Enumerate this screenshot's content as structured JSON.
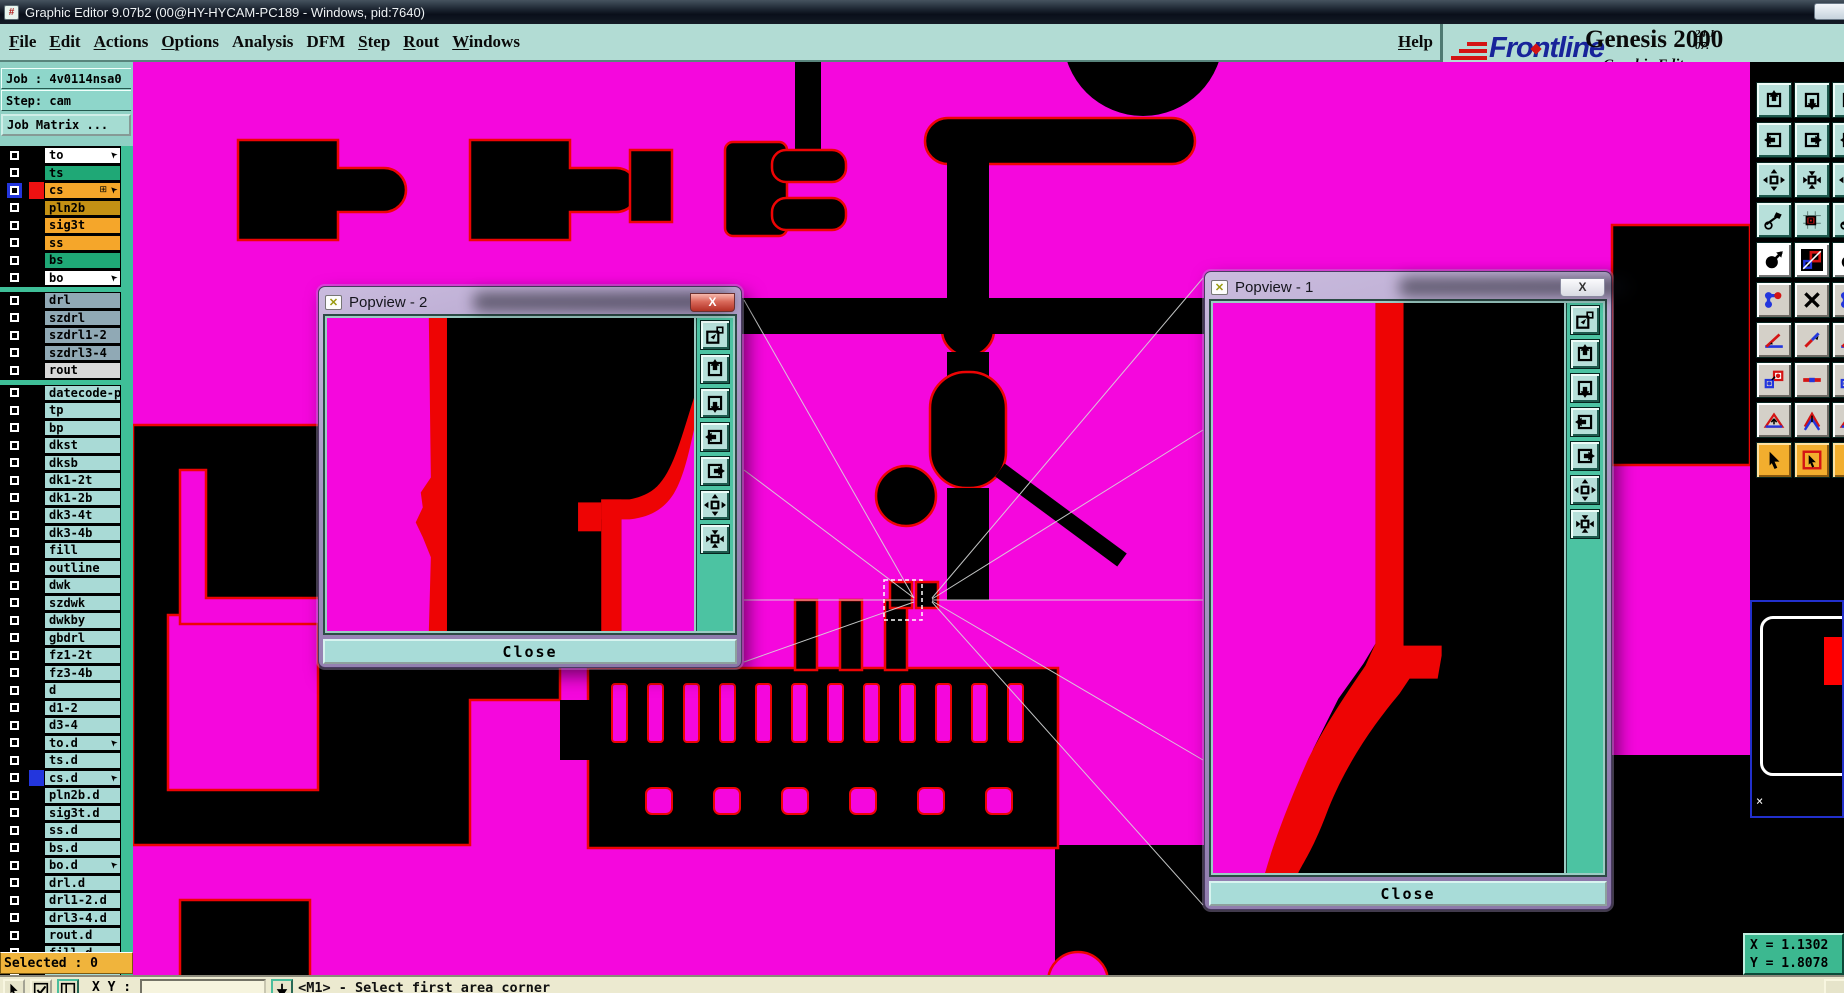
{
  "window": {
    "title": "Graphic Editor 9.07b2 (00@HY-HYCAM-PC189 - Windows, pid:7640)"
  },
  "menu": {
    "items": [
      {
        "label": "File",
        "u": 0
      },
      {
        "label": "Edit",
        "u": 0
      },
      {
        "label": "Actions",
        "u": 0
      },
      {
        "label": "Options",
        "u": 0
      },
      {
        "label": "Analysis",
        "u": -1
      },
      {
        "label": "DFM",
        "u": -1
      },
      {
        "label": "Step",
        "u": 0
      },
      {
        "label": "Rout",
        "u": 0
      },
      {
        "label": "Windows",
        "u": 0
      }
    ],
    "help": {
      "label": "Help",
      "u": 0
    }
  },
  "brand": {
    "logo": "Frontline",
    "product": "Genesis 2000",
    "edition": "Graphic Editor",
    "date": "24 J",
    "time": "07:"
  },
  "sidebar": {
    "job": "Job : 4v0114nsa0",
    "step": "Step: cam",
    "job_matrix": "Job Matrix ...",
    "selected": "Selected : 0",
    "layers": [
      {
        "name": "to",
        "bg": "#ffffff",
        "arrow": true
      },
      {
        "name": "ts",
        "bg": "#1fa876"
      },
      {
        "name": "cs",
        "bg": "#f5a62a",
        "swatch": "#ee1111",
        "selected": true,
        "arrow": true,
        "grid": true
      },
      {
        "name": "pln2b",
        "bg": "#c49114"
      },
      {
        "name": "sig3t",
        "bg": "#f5a62a"
      },
      {
        "name": "ss",
        "bg": "#f5a62a"
      },
      {
        "name": "bs",
        "bg": "#1fa876"
      },
      {
        "name": "bo",
        "bg": "#ffffff",
        "arrow": true,
        "gap_after": true
      },
      {
        "name": "drl",
        "bg": "#90a9b5"
      },
      {
        "name": "szdrl",
        "bg": "#90a9b5"
      },
      {
        "name": "szdrl1-2",
        "bg": "#90a9b5"
      },
      {
        "name": "szdrl3-4",
        "bg": "#90a9b5"
      },
      {
        "name": "rout",
        "bg": "#d8d8d8",
        "gap_after": true
      },
      {
        "name": "datecode-pbo",
        "bg": "#a9dad6"
      },
      {
        "name": "tp",
        "bg": "#a9dad6"
      },
      {
        "name": "bp",
        "bg": "#a9dad6"
      },
      {
        "name": "dkst",
        "bg": "#a9dad6"
      },
      {
        "name": "dksb",
        "bg": "#a9dad6"
      },
      {
        "name": "dk1-2t",
        "bg": "#a9dad6"
      },
      {
        "name": "dk1-2b",
        "bg": "#a9dad6"
      },
      {
        "name": "dk3-4t",
        "bg": "#a9dad6"
      },
      {
        "name": "dk3-4b",
        "bg": "#a9dad6"
      },
      {
        "name": "fill",
        "bg": "#a9dad6"
      },
      {
        "name": "outline",
        "bg": "#a9dad6"
      },
      {
        "name": "dwk",
        "bg": "#a9dad6"
      },
      {
        "name": "szdwk",
        "bg": "#a9dad6"
      },
      {
        "name": "dwkby",
        "bg": "#a9dad6"
      },
      {
        "name": "gbdrl",
        "bg": "#a9dad6"
      },
      {
        "name": "fz1-2t",
        "bg": "#a9dad6"
      },
      {
        "name": "fz3-4b",
        "bg": "#a9dad6"
      },
      {
        "name": "d",
        "bg": "#a9dad6"
      },
      {
        "name": "d1-2",
        "bg": "#a9dad6"
      },
      {
        "name": "d3-4",
        "bg": "#a9dad6"
      },
      {
        "name": "to.d",
        "bg": "#a9dad6",
        "arrow": true
      },
      {
        "name": "ts.d",
        "bg": "#a9dad6"
      },
      {
        "name": "cs.d",
        "bg": "#a9dad6",
        "swatch": "#2336dd",
        "arrow": true
      },
      {
        "name": "pln2b.d",
        "bg": "#a9dad6"
      },
      {
        "name": "sig3t.d",
        "bg": "#a9dad6"
      },
      {
        "name": "ss.d",
        "bg": "#a9dad6"
      },
      {
        "name": "bs.d",
        "bg": "#a9dad6"
      },
      {
        "name": "bo.d",
        "bg": "#a9dad6",
        "arrow": true
      },
      {
        "name": "drl.d",
        "bg": "#a9dad6"
      },
      {
        "name": "drl1-2.d",
        "bg": "#a9dad6"
      },
      {
        "name": "drl3-4.d",
        "bg": "#a9dad6"
      },
      {
        "name": "rout.d",
        "bg": "#a9dad6"
      },
      {
        "name": "fill.d",
        "bg": "#a9dad6"
      },
      {
        "name": "outline.d",
        "bg": "#a9dad6"
      }
    ]
  },
  "popviews": [
    {
      "title": "Popview - 2",
      "close_label": "Close"
    },
    {
      "title": "Popview - 1",
      "close_label": "Close"
    }
  ],
  "popview_tools": [
    "popout-icon",
    "pan-up-icon",
    "pan-down-icon",
    "pan-left-icon",
    "pan-right-icon",
    "zoom-contract-icon",
    "zoom-expand-icon"
  ],
  "right_toolbar": {
    "rows": [
      {
        "style": "teal",
        "icons": [
          "view-pan-up-icon",
          "view-pan-down-icon"
        ]
      },
      {
        "style": "teal",
        "icons": [
          "view-pan-left-icon",
          "view-pan-right-icon"
        ]
      },
      {
        "style": "teal",
        "icons": [
          "zoom-contract-icon",
          "zoom-expand-icon"
        ]
      },
      {
        "style": "teal",
        "icons": [
          "tools-icon",
          "clip-area-icon"
        ]
      },
      {
        "style": "white",
        "icons": [
          "select-feature-icon",
          "layer-compare-icon"
        ]
      },
      {
        "style": "gray",
        "icons": [
          "net-select-icon",
          "delete-feature-icon"
        ]
      },
      {
        "style": "gray",
        "icons": [
          "measure-angle-icon",
          "measure-line-icon"
        ]
      },
      {
        "style": "gray",
        "icons": [
          "copy-feature-icon",
          "stretch-feature-icon"
        ]
      },
      {
        "style": "gray",
        "icons": [
          "add-polygon-icon",
          "add-arrow-icon"
        ]
      },
      {
        "style": "orange",
        "icons": [
          "pointer-mode-icon",
          "select-area-icon"
        ]
      }
    ]
  },
  "minimap": {
    "mark": "×"
  },
  "statusbar": {
    "xy_label": "X Y :",
    "input_value": "",
    "hint": "<M1> - Select first area corner",
    "button_icons": [
      "cursor-icon",
      "check-icon",
      "panel-icon",
      "down-arrow-icon"
    ]
  },
  "coords": {
    "x": "X = 1.1302",
    "y": "Y = 1.8078"
  },
  "colors": {
    "magenta": "#f507dd",
    "red": "#ee0404",
    "teal_ui": "#b2dcd4",
    "panel_green": "#3cb890",
    "selected_bar": "#f0b43c"
  }
}
